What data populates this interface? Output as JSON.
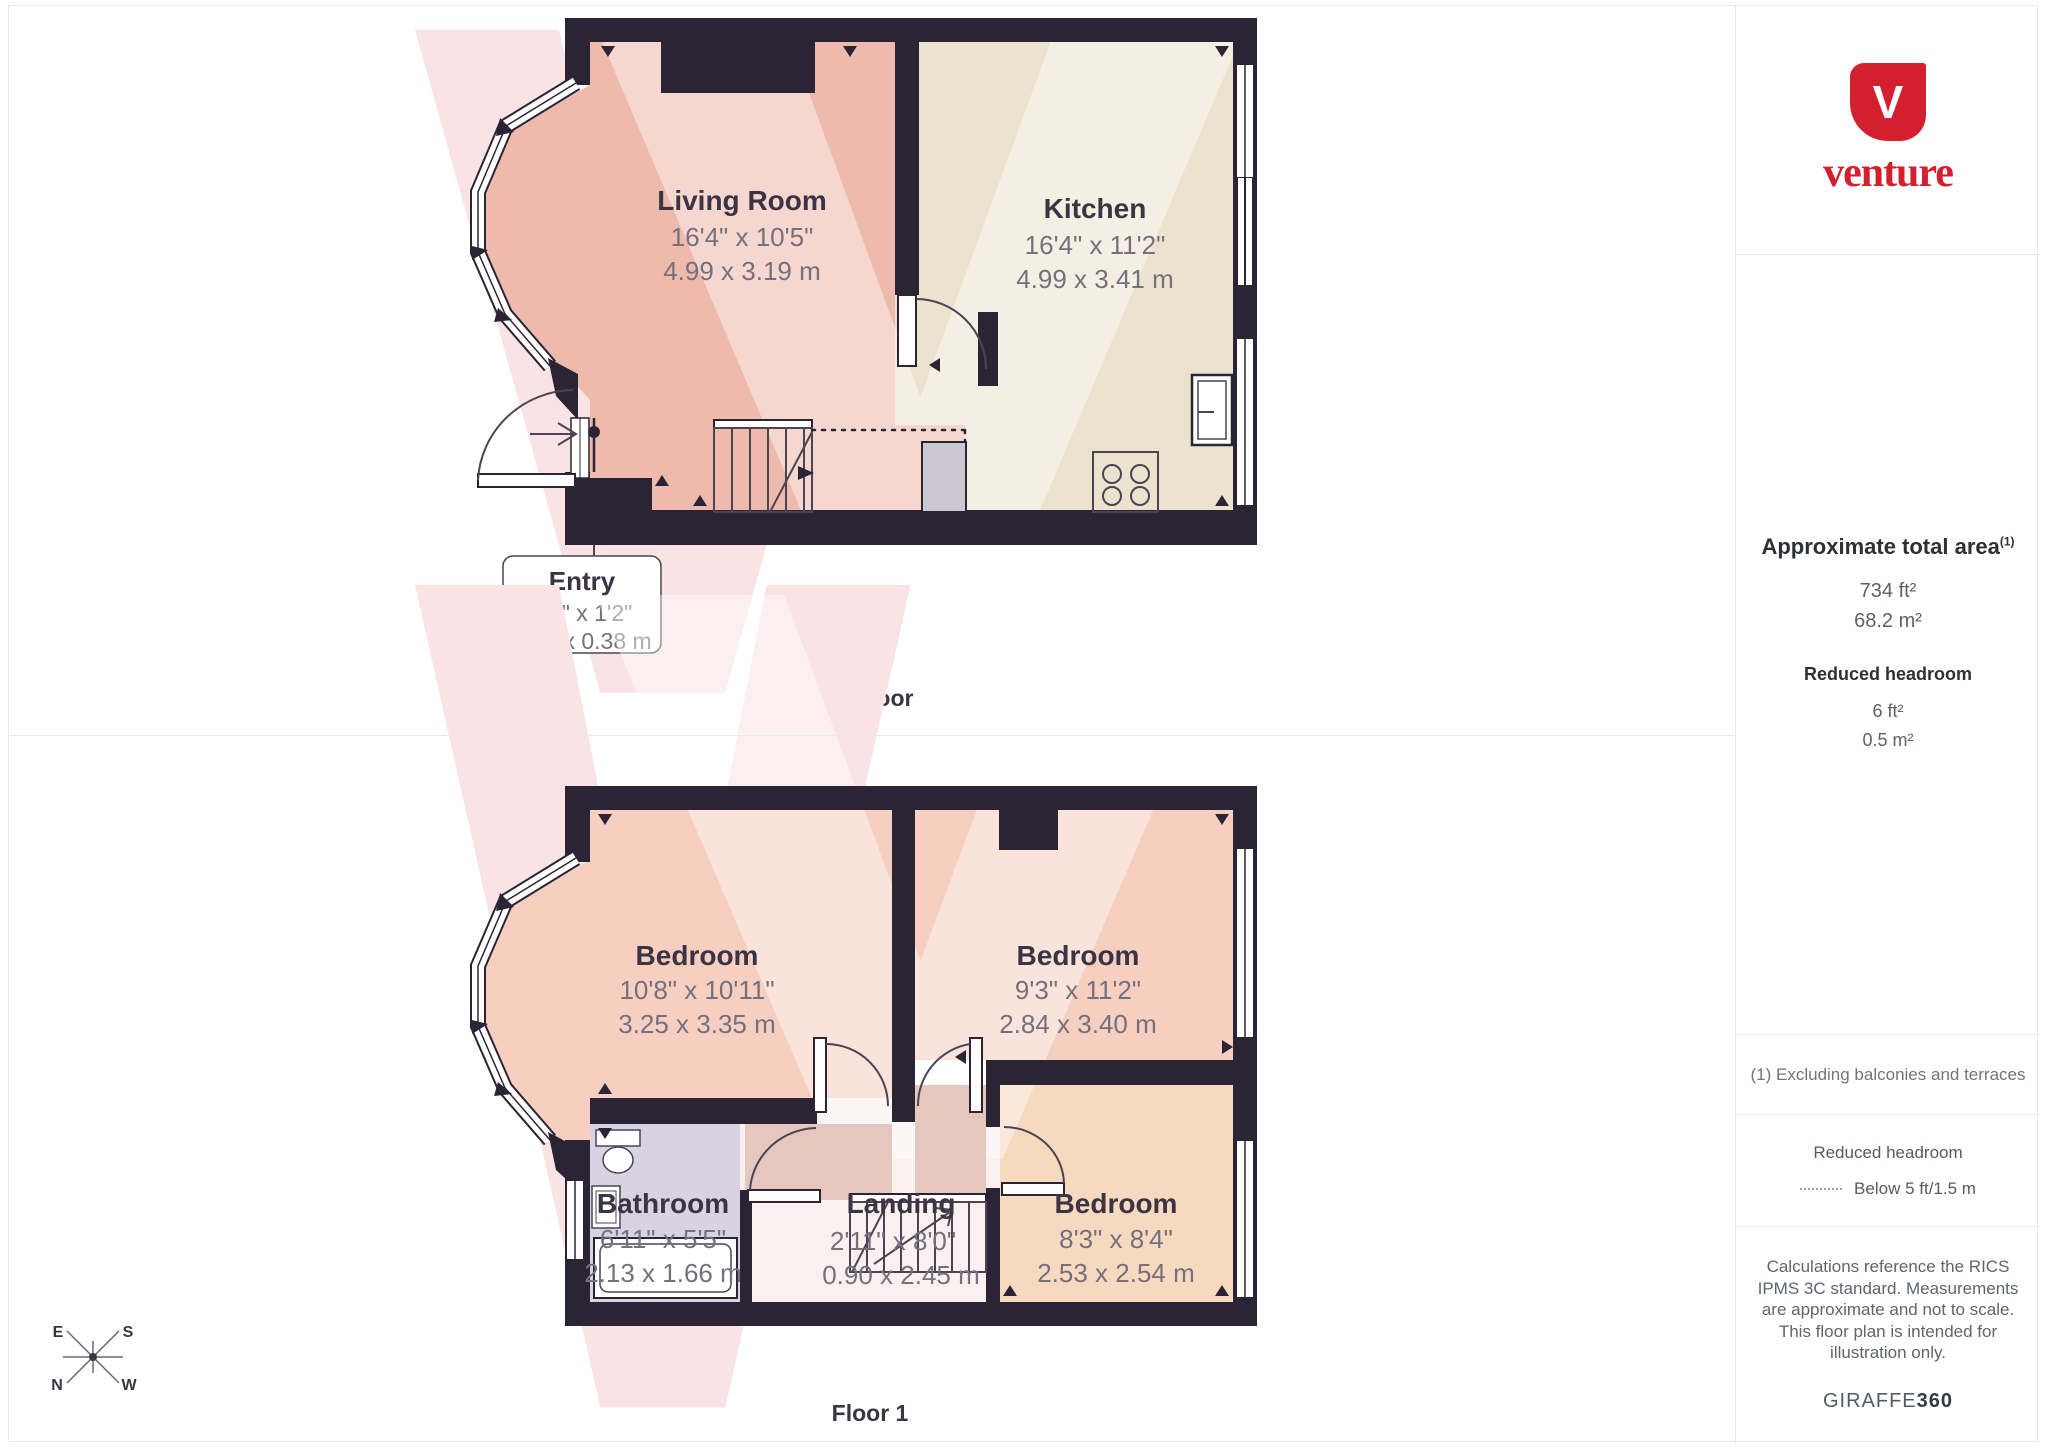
{
  "brand": {
    "mark_letter": "V",
    "wordmark": "venture",
    "color": "#d41f2f"
  },
  "sidebar": {
    "total_area": {
      "title": "Approximate total area",
      "superscript": "(1)",
      "imperial": "734 ft²",
      "metric": "68.2 m²"
    },
    "reduced_headroom": {
      "title": "Reduced headroom",
      "imperial": "6 ft²",
      "metric": "0.5 m²"
    },
    "footnote": "(1) Excluding balconies and terraces",
    "legend": {
      "title": "Reduced headroom",
      "entry": "Below 5 ft/1.5 m"
    },
    "disclaimer": "Calculations reference the RICS IPMS 3C standard. Measurements are approximate and not to scale. This floor plan is intended for illustration only.",
    "credit_normal": "GIRAFFE",
    "credit_bold": "360"
  },
  "floors": {
    "ground": {
      "label": "Ground Floor",
      "rooms": {
        "living": {
          "name": "Living Room",
          "imperial": "16'4\" x 10'5\"",
          "metric": "4.99 x 3.19 m"
        },
        "kitchen": {
          "name": "Kitchen",
          "imperial": "16'4\" x 11'2\"",
          "metric": "4.99 x 3.41 m"
        },
        "entry": {
          "name": "Entry",
          "imperial": "5'4\" x 1'2\"",
          "metric": "1.64 x 0.38 m"
        }
      }
    },
    "first": {
      "label": "Floor 1",
      "rooms": {
        "bedroom1": {
          "name": "Bedroom",
          "imperial": "10'8\" x 10'11\"",
          "metric": "3.25 x 3.35 m"
        },
        "bedroom2": {
          "name": "Bedroom",
          "imperial": "9'3\" x 11'2\"",
          "metric": "2.84 x 3.40 m"
        },
        "bedroom3": {
          "name": "Bedroom",
          "imperial": "8'3\" x 8'4\"",
          "metric": "2.53 x 2.54 m"
        },
        "bathroom": {
          "name": "Bathroom",
          "imperial": "6'11\" x 5'5\"",
          "metric": "2.13 x 1.66 m"
        },
        "landing": {
          "name": "Landing",
          "imperial": "2'11\" x 8'0\"",
          "metric": "0.90 x 2.45 m"
        }
      }
    }
  },
  "compass": {
    "n": "N",
    "e": "E",
    "s": "S",
    "w": "W"
  }
}
